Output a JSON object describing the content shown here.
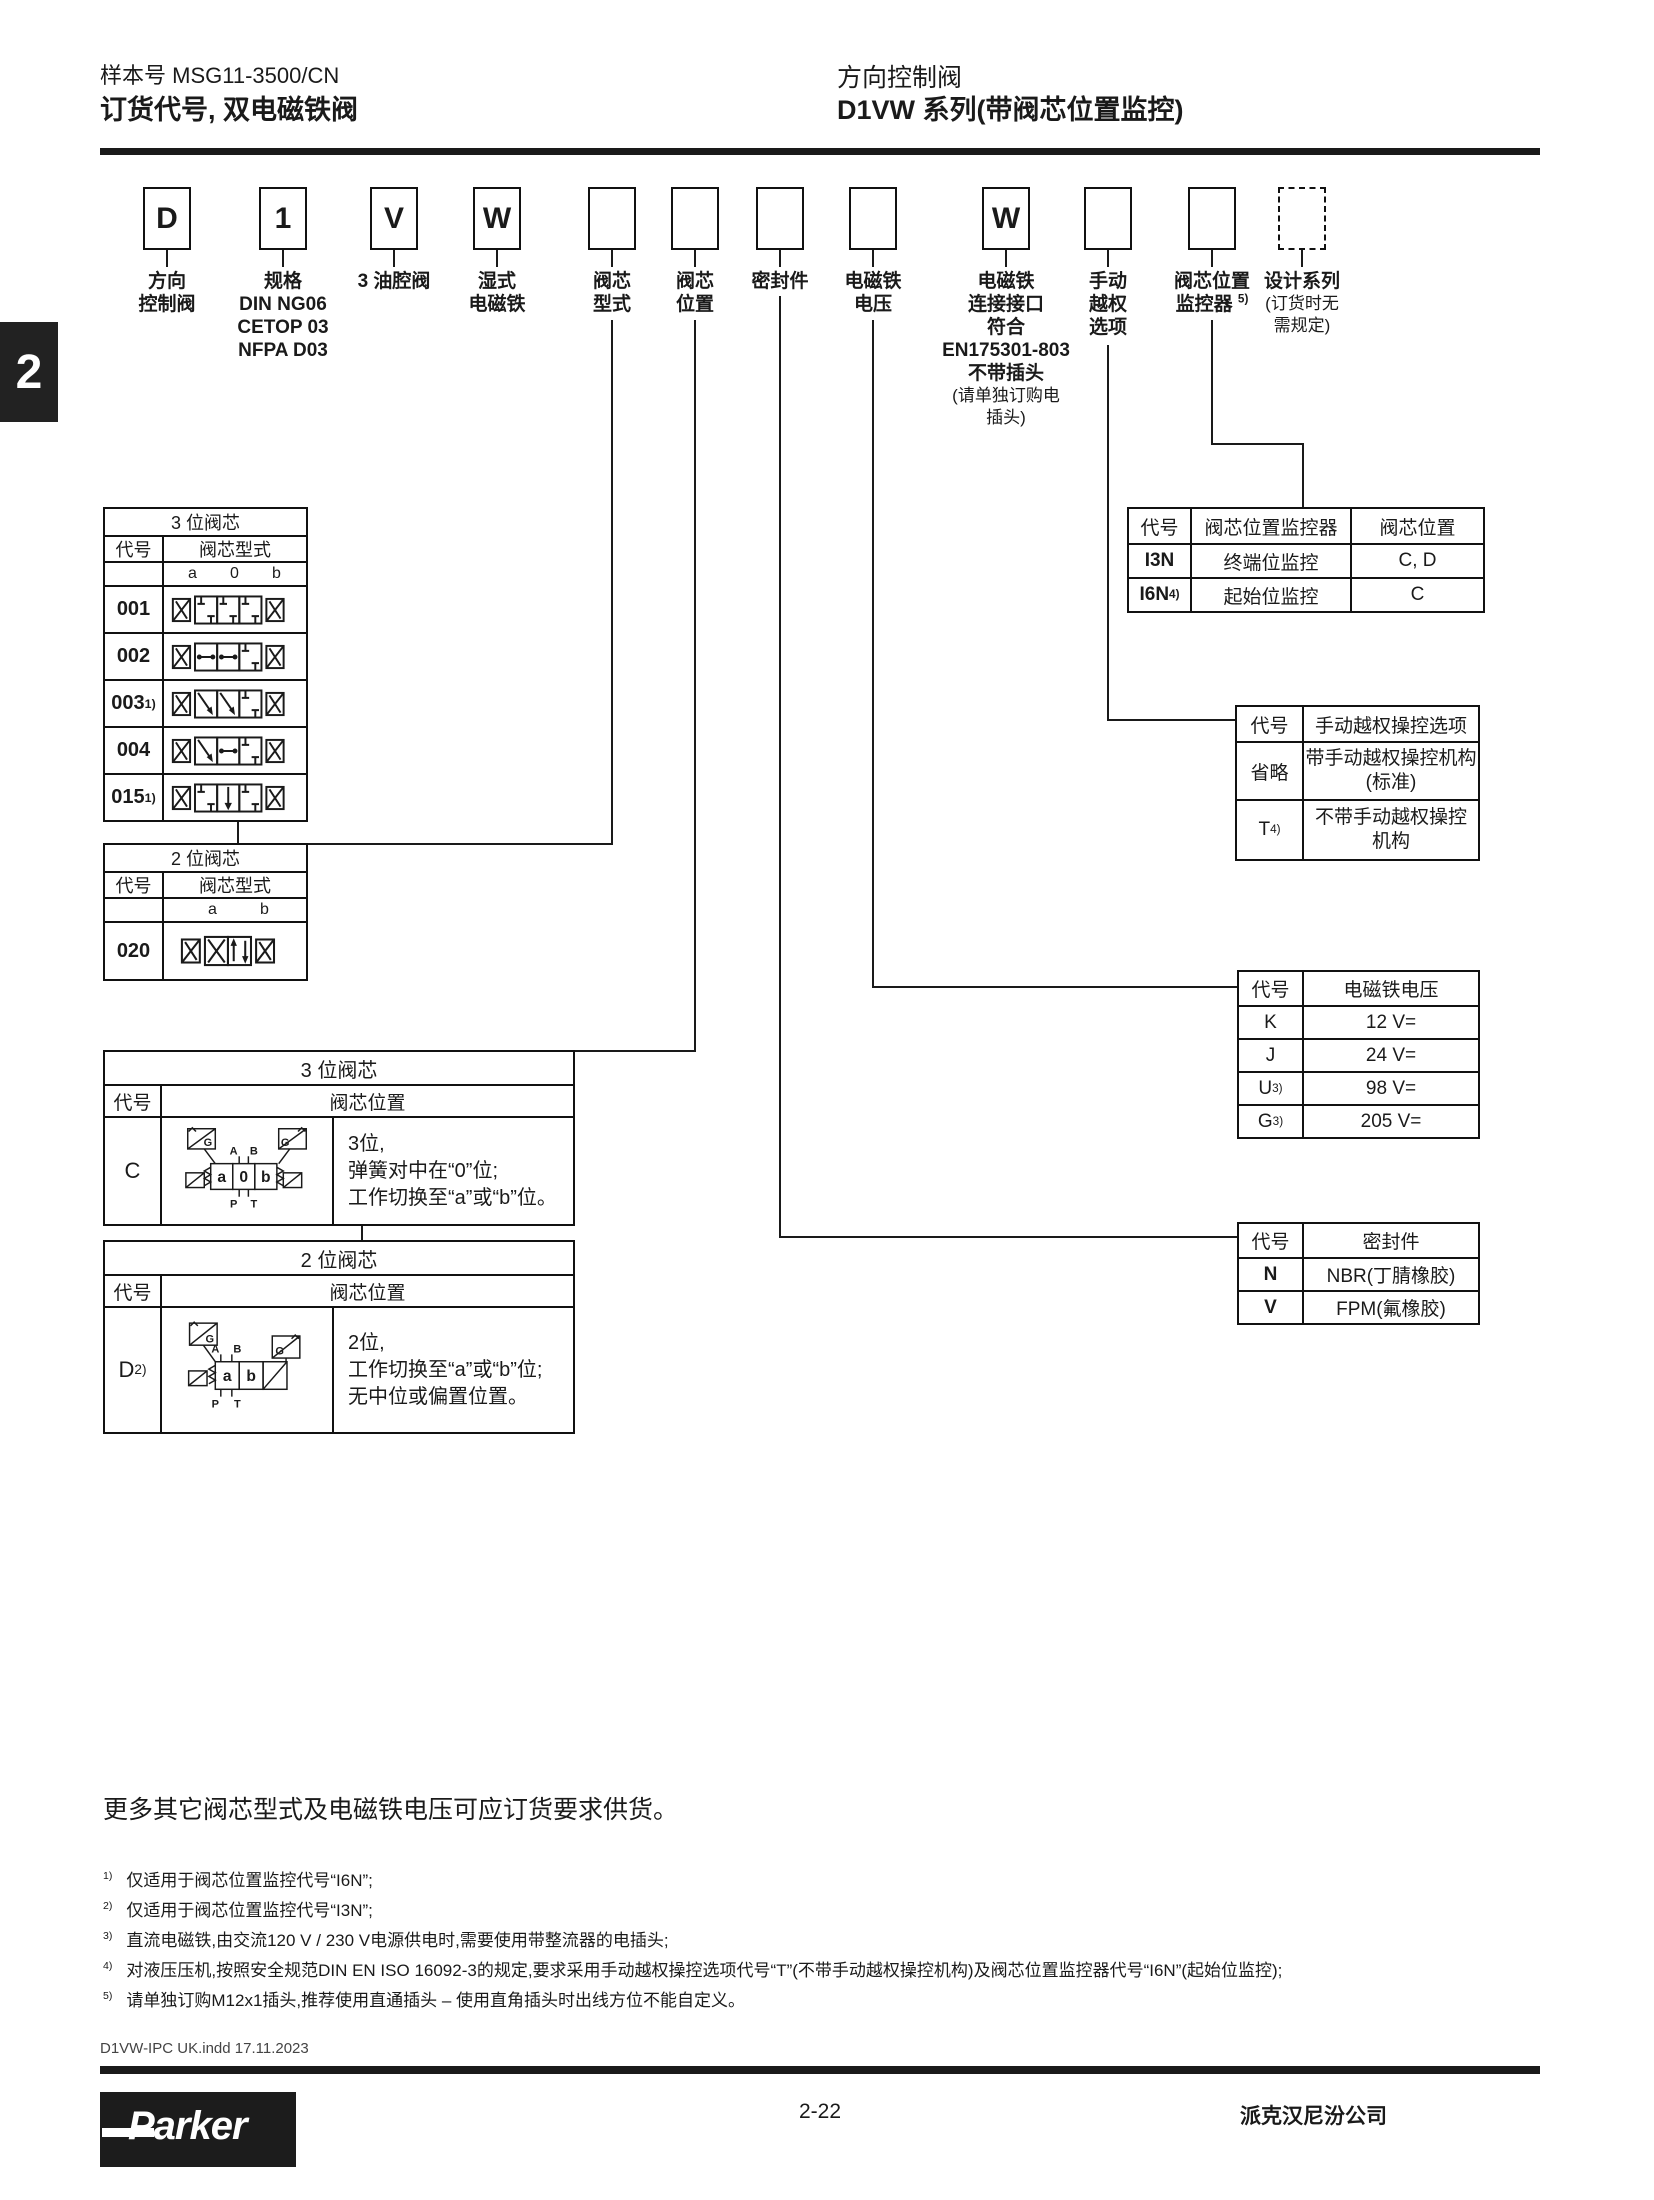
{
  "header": {
    "doc_number": "样本号 MSG11-3500/CN",
    "title_left": "订货代号, 双电磁铁阀",
    "category": "方向控制阀",
    "series_title": "D1VW 系列(带阀芯位置监控)",
    "section_tab": "2"
  },
  "order_code": {
    "codes": [
      "D",
      "1",
      "V",
      "W",
      "",
      "",
      "",
      "",
      "W",
      "",
      "",
      ""
    ],
    "labels": {
      "b1": [
        "方向",
        "控制阀"
      ],
      "b2": [
        "规格",
        "DIN NG06",
        "CETOP 03",
        "NFPA D03"
      ],
      "b3": [
        "3 油腔阀"
      ],
      "b4": [
        "湿式",
        "电磁铁"
      ],
      "b5": [
        "阀芯",
        "型式"
      ],
      "b6": [
        "阀芯",
        "位置"
      ],
      "b7": [
        "密封件"
      ],
      "b8": [
        "电磁铁",
        "电压"
      ],
      "b9": [
        "电磁铁",
        "连接接口",
        "符合",
        "EN175301-803",
        "不带插头"
      ],
      "b9_note": [
        "(请单独订购电",
        "插头)"
      ],
      "b10": [
        "手动",
        "越权",
        "选项"
      ],
      "b11_line1": "阀芯位置",
      "b11_line2": "监控器 ",
      "b11_sup": "5)",
      "b12": "设计系列",
      "b12_note": [
        "(订货时无",
        "需规定)"
      ]
    }
  },
  "spool_type_3pos": {
    "title": "3 位阀芯",
    "col_code": "代号",
    "col_type": "阀芯型式",
    "pos_a": "a",
    "pos_o": "0",
    "pos_b": "b",
    "rows": [
      {
        "code": "001",
        "sup": ""
      },
      {
        "code": "002",
        "sup": ""
      },
      {
        "code": "003",
        "sup": "1)"
      },
      {
        "code": "004",
        "sup": ""
      },
      {
        "code": "015",
        "sup": "1)"
      }
    ]
  },
  "spool_type_2pos": {
    "title": "2 位阀芯",
    "col_code": "代号",
    "col_type": "阀芯型式",
    "pos_a": "a",
    "pos_b": "b",
    "rows": [
      {
        "code": "020",
        "sup": ""
      }
    ]
  },
  "spool_pos_3": {
    "title": "3 位阀芯",
    "col_code": "代号",
    "col_pos": "阀芯位置",
    "row_code": "C",
    "row_sup": "",
    "desc": [
      "3位,",
      "弹簧对中在“0”位;",
      "工作切换至“a”或“b”位。"
    ],
    "sym": {
      "a": "a",
      "o": "0",
      "b": "b",
      "A": "A",
      "B": "B",
      "P": "P",
      "T": "T",
      "G": "G"
    }
  },
  "spool_pos_2": {
    "title": "2 位阀芯",
    "col_code": "代号",
    "col_pos": "阀芯位置",
    "row_code": "D ",
    "row_sup": "2)",
    "desc": [
      "2位,",
      "工作切换至“a”或“b”位;",
      "无中位或偏置位置。"
    ],
    "sym": {
      "a": "a",
      "b": "b",
      "A": "A",
      "B": "B",
      "P": "P",
      "T": "T",
      "G": "G"
    }
  },
  "monitor_table": {
    "col_code": "代号",
    "col_monitor": "阀芯位置监控器",
    "col_pos": "阀芯位置",
    "rows": [
      {
        "code": "I3N",
        "sup": "",
        "monitor": "终端位监控",
        "pos": "C, D"
      },
      {
        "code": "I6N ",
        "sup": "4)",
        "monitor": "起始位监控",
        "pos": "C"
      }
    ]
  },
  "override_table": {
    "col_code": "代号",
    "col_option": "手动越权操控选项",
    "rows": [
      {
        "code": "省略",
        "sup": "",
        "option1": "带手动越权操控机构",
        "option2": "(标准)"
      },
      {
        "code": "T",
        "sup": "4)",
        "option1": "不带手动越权操控",
        "option2": "机构"
      }
    ]
  },
  "voltage_table": {
    "col_code": "代号",
    "col_voltage": "电磁铁电压",
    "rows": [
      {
        "code": "K",
        "sup": "",
        "voltage": "12 V="
      },
      {
        "code": "J",
        "sup": "",
        "voltage": "24 V="
      },
      {
        "code": "U",
        "sup": "3)",
        "voltage": "98 V="
      },
      {
        "code": "G",
        "sup": "3)",
        "voltage": "205 V="
      }
    ]
  },
  "seal_table": {
    "col_code": "代号",
    "col_seal": "密封件",
    "rows": [
      {
        "code": "N",
        "seal": "NBR(丁腈橡胶)"
      },
      {
        "code": "V",
        "seal": "FPM(氟橡胶)"
      }
    ]
  },
  "notes": {
    "supply_note": "更多其它阀芯型式及电磁铁电压可应订货要求供货。",
    "footnotes": [
      {
        "sup": "1)",
        "text": "仅适用于阀芯位置监控代号“I6N”;"
      },
      {
        "sup": "2)",
        "text": "仅适用于阀芯位置监控代号“I3N”;"
      },
      {
        "sup": "3)",
        "text": "直流电磁铁,由交流120 V / 230 V电源供电时,需要使用带整流器的电插头;"
      },
      {
        "sup": "4)",
        "text": "对液压压机,按照安全规范DIN EN ISO 16092-3的规定,要求采用手动越权操控选项代号“T”(不带手动越权操控机构)及阀芯位置监控器代号“I6N”(起始位监控);"
      },
      {
        "sup": "5)",
        "text": "请单独订购M12x1插头,推荐使用直通插头 – 使用直角插头时出线方位不能自定义。"
      }
    ],
    "imprint": "D1VW-IPC UK.indd 17.11.2023"
  },
  "footer": {
    "page_number": "2-22",
    "company": "派克汉尼汾公司",
    "brand": "Parker"
  }
}
